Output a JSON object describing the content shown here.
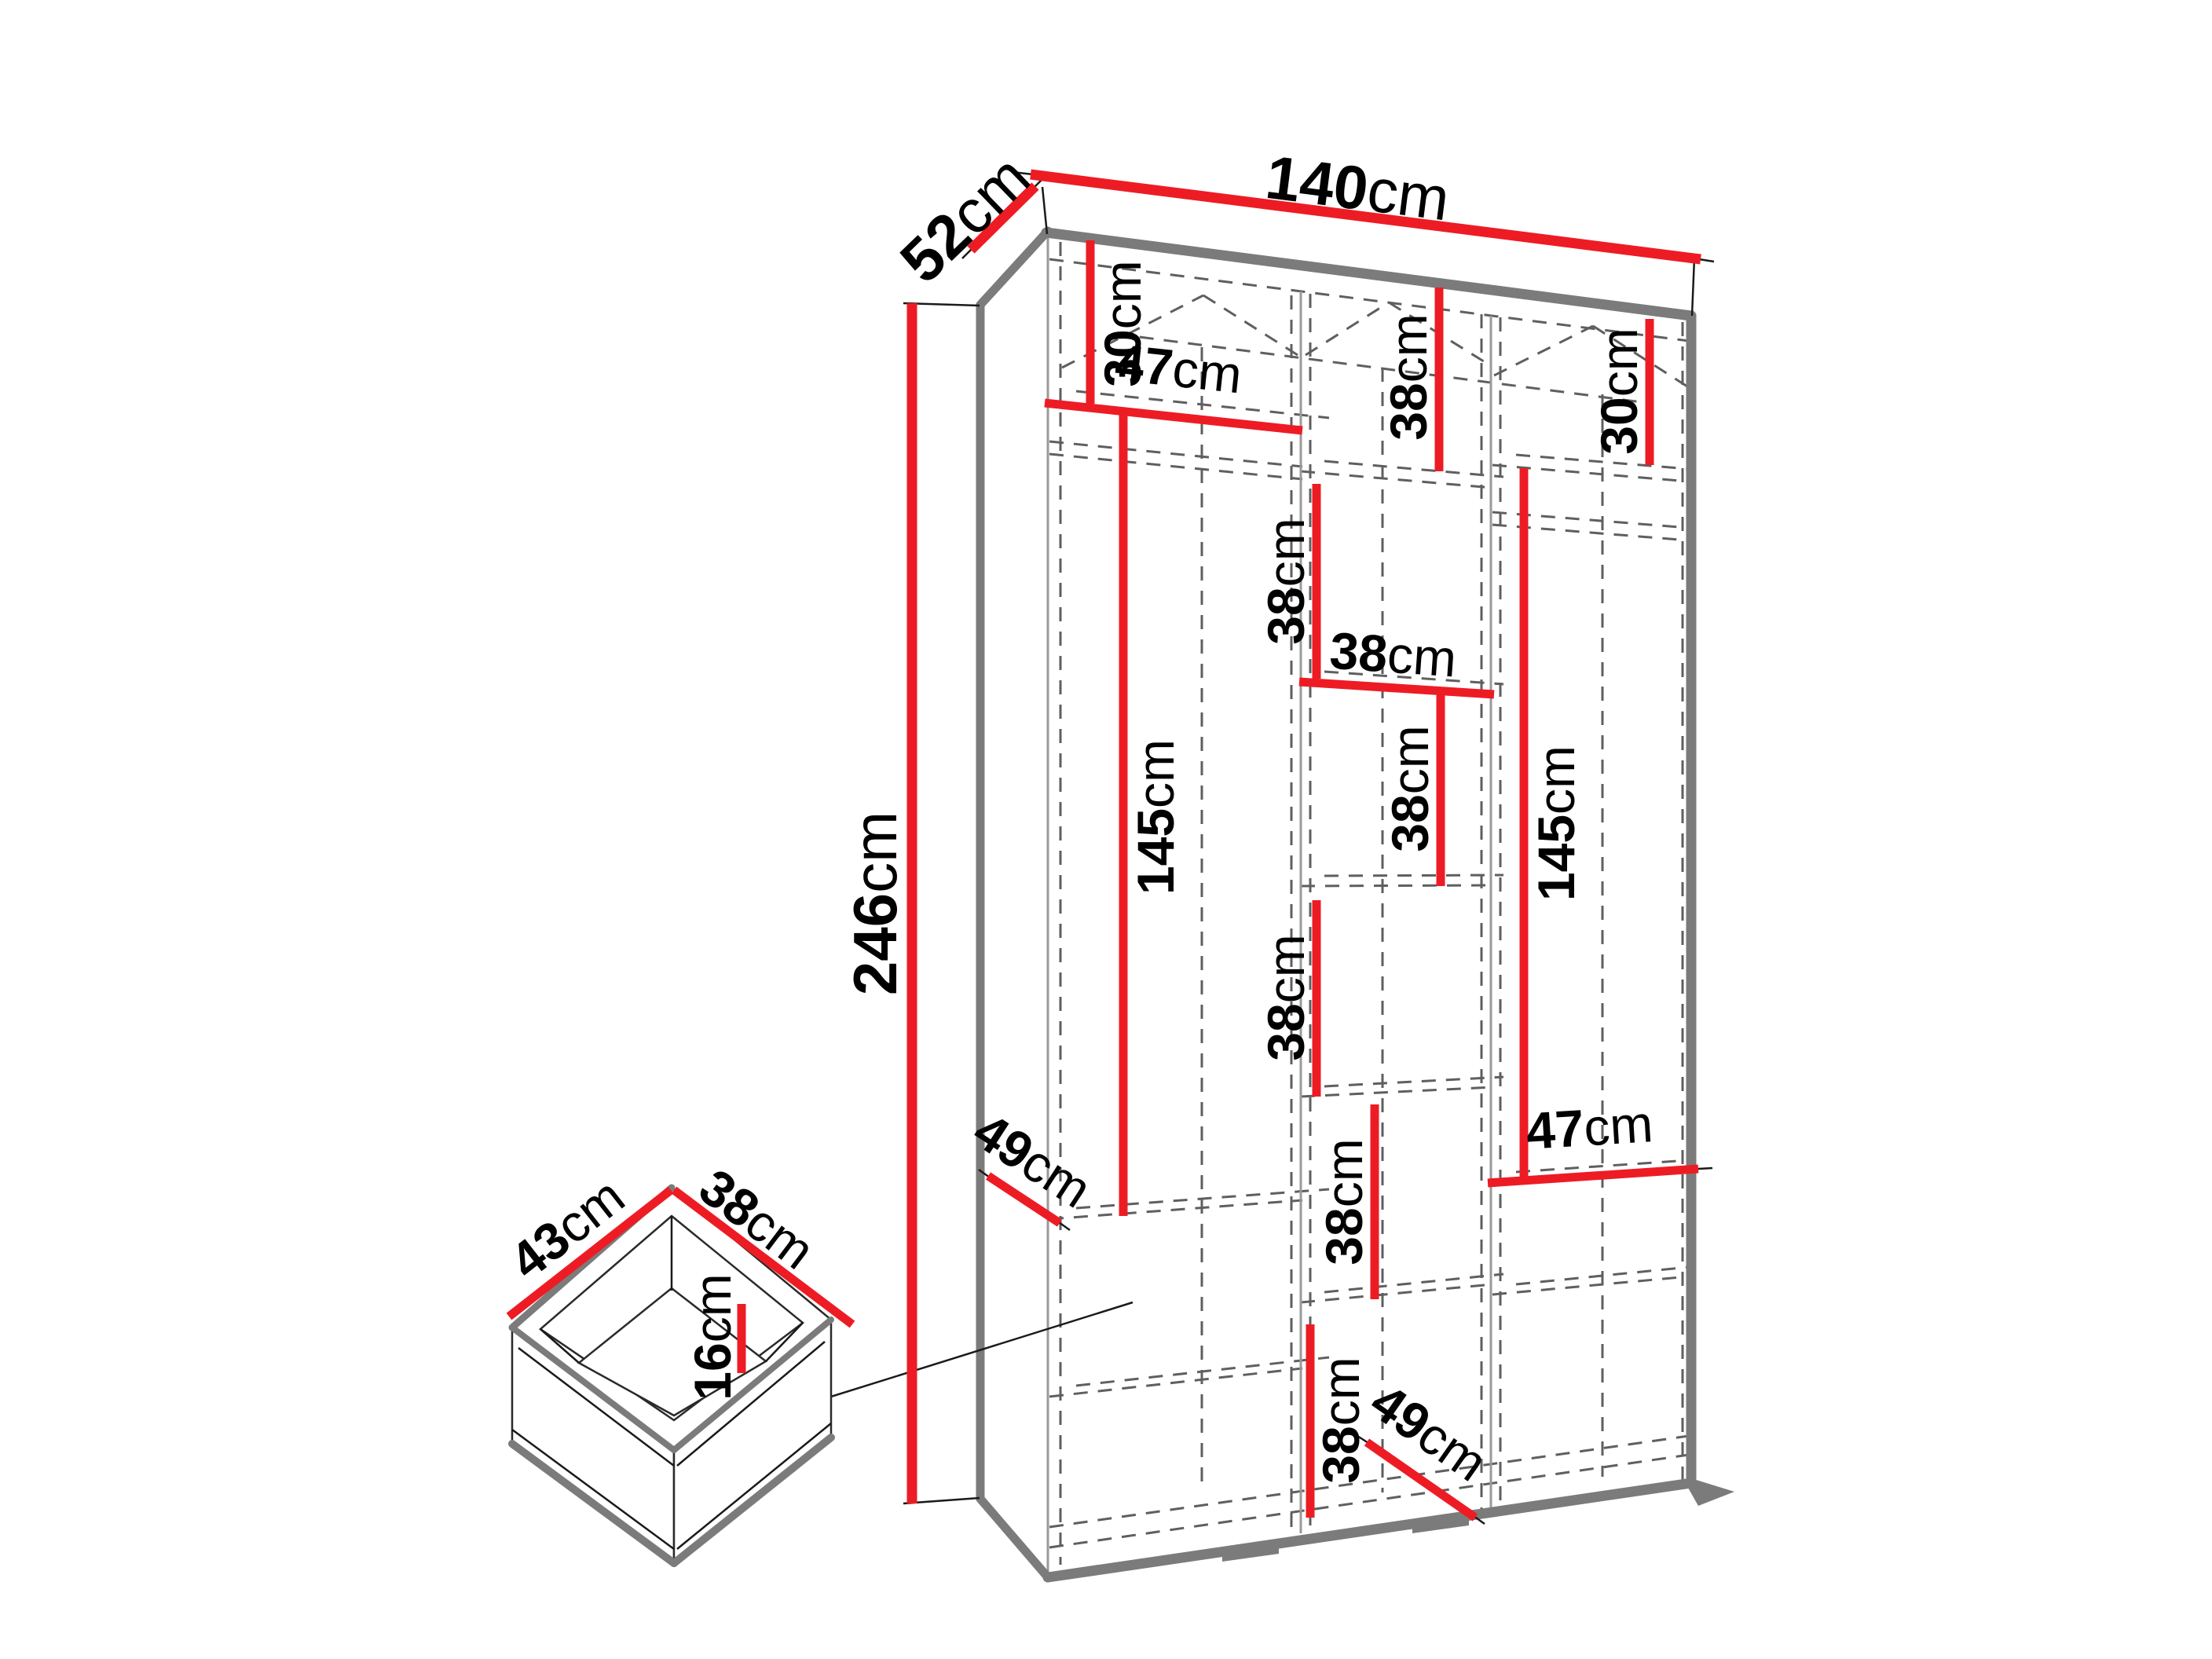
{
  "unit": "cm",
  "palette": {
    "dimension_red": "#ed1c24",
    "carcass_gray": "#7b7b7b",
    "hidden_line_gray": "#5f5f5f",
    "label_black": "#000000",
    "background": "#ffffff"
  },
  "wardrobe": {
    "width": {
      "num": "140",
      "unit": "cm"
    },
    "depth": {
      "num": "52",
      "unit": "cm"
    },
    "height": {
      "num": "246",
      "unit": "cm"
    },
    "left_column": {
      "top_shelf_height": {
        "num": "30",
        "unit": "cm"
      },
      "shelf_width": {
        "num": "47",
        "unit": "cm"
      },
      "hanging_height": {
        "num": "145",
        "unit": "cm"
      },
      "shelf_depth": {
        "num": "49",
        "unit": "cm"
      }
    },
    "middle_column": {
      "column_width": {
        "num": "38",
        "unit": "cm"
      },
      "shelf_spacings": [
        {
          "num": "38",
          "unit": "cm"
        },
        {
          "num": "38",
          "unit": "cm"
        },
        {
          "num": "38",
          "unit": "cm"
        },
        {
          "num": "38",
          "unit": "cm"
        },
        {
          "num": "38",
          "unit": "cm"
        },
        {
          "num": "38",
          "unit": "cm"
        }
      ]
    },
    "right_column": {
      "top_shelf_height": {
        "num": "30",
        "unit": "cm"
      },
      "hanging_height": {
        "num": "145",
        "unit": "cm"
      },
      "shelf_width": {
        "num": "47",
        "unit": "cm"
      }
    },
    "base": {
      "floor_depth": {
        "num": "49",
        "unit": "cm"
      }
    }
  },
  "drawer": {
    "width": {
      "num": "43",
      "unit": "cm"
    },
    "depth": {
      "num": "38",
      "unit": "cm"
    },
    "height": {
      "num": "16",
      "unit": "cm"
    }
  }
}
